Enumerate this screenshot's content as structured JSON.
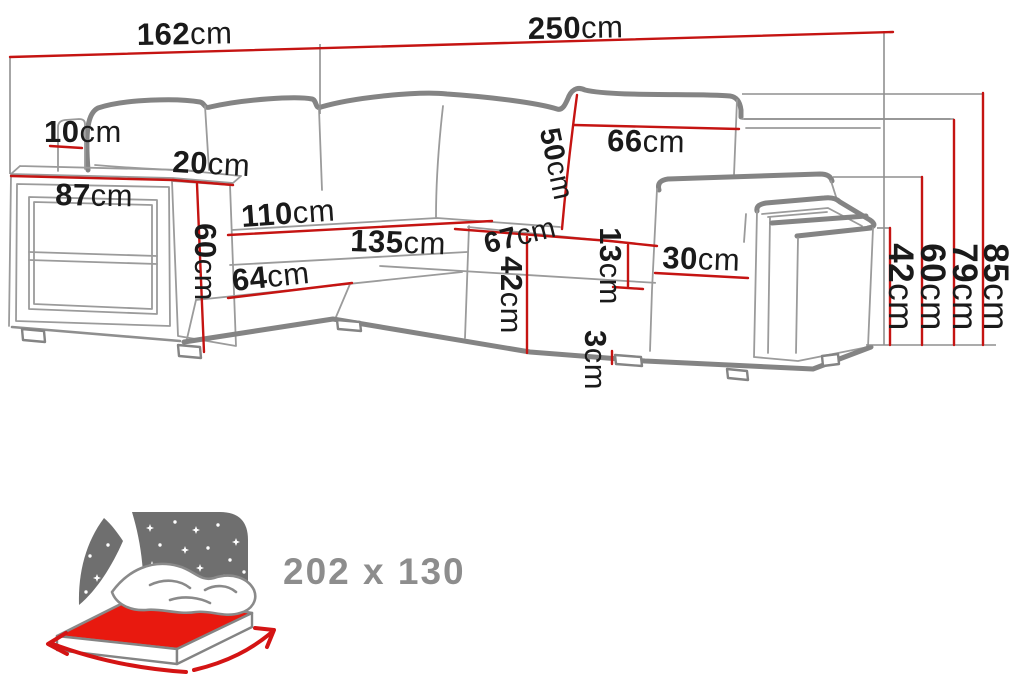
{
  "diagram": {
    "kind": "corner-sofa-dimension-diagram",
    "unit": "cm",
    "colors": {
      "dimension_red": "#c51412",
      "sketch_gray": "#8a8a8a",
      "label_black": "#1a1a1a",
      "night_panel_gray": "#6f6f6f",
      "mattress_red": "#e8190f",
      "size_text_gray": "#8d8d8d"
    }
  },
  "dims": {
    "total_width_left": {
      "value": "162",
      "unit": "cm"
    },
    "total_width_right": {
      "value": "250",
      "unit": "cm"
    },
    "back_panel_width": {
      "value": "10",
      "unit": "cm"
    },
    "armrest_top_depth": {
      "value": "20",
      "unit": "cm"
    },
    "shelf_armrest_width": {
      "value": "87",
      "unit": "cm"
    },
    "shelf_armrest_height": {
      "value": "60",
      "unit": "cm"
    },
    "chaise_back_length": {
      "value": "110",
      "unit": "cm"
    },
    "chaise_front_length": {
      "value": "64",
      "unit": "cm"
    },
    "seat_front_length": {
      "value": "135",
      "unit": "cm"
    },
    "back_cushion_width": {
      "value": "66",
      "unit": "cm"
    },
    "back_cushion_height": {
      "value": "50",
      "unit": "cm"
    },
    "seat_depth": {
      "value": "67",
      "unit": "cm"
    },
    "seat_front_height": {
      "value": "42",
      "unit": "cm"
    },
    "back_gap_height": {
      "value": "13",
      "unit": "cm"
    },
    "leg_height": {
      "value": "3",
      "unit": "cm"
    },
    "armrest_width": {
      "value": "30",
      "unit": "cm"
    },
    "height_seat": {
      "value": "42",
      "unit": "cm"
    },
    "height_armrest": {
      "value": "60",
      "unit": "cm"
    },
    "height_backrest": {
      "value": "79",
      "unit": "cm"
    },
    "height_total": {
      "value": "85",
      "unit": "cm"
    }
  },
  "sleep_icon": {
    "size_label": "202 x 130"
  }
}
